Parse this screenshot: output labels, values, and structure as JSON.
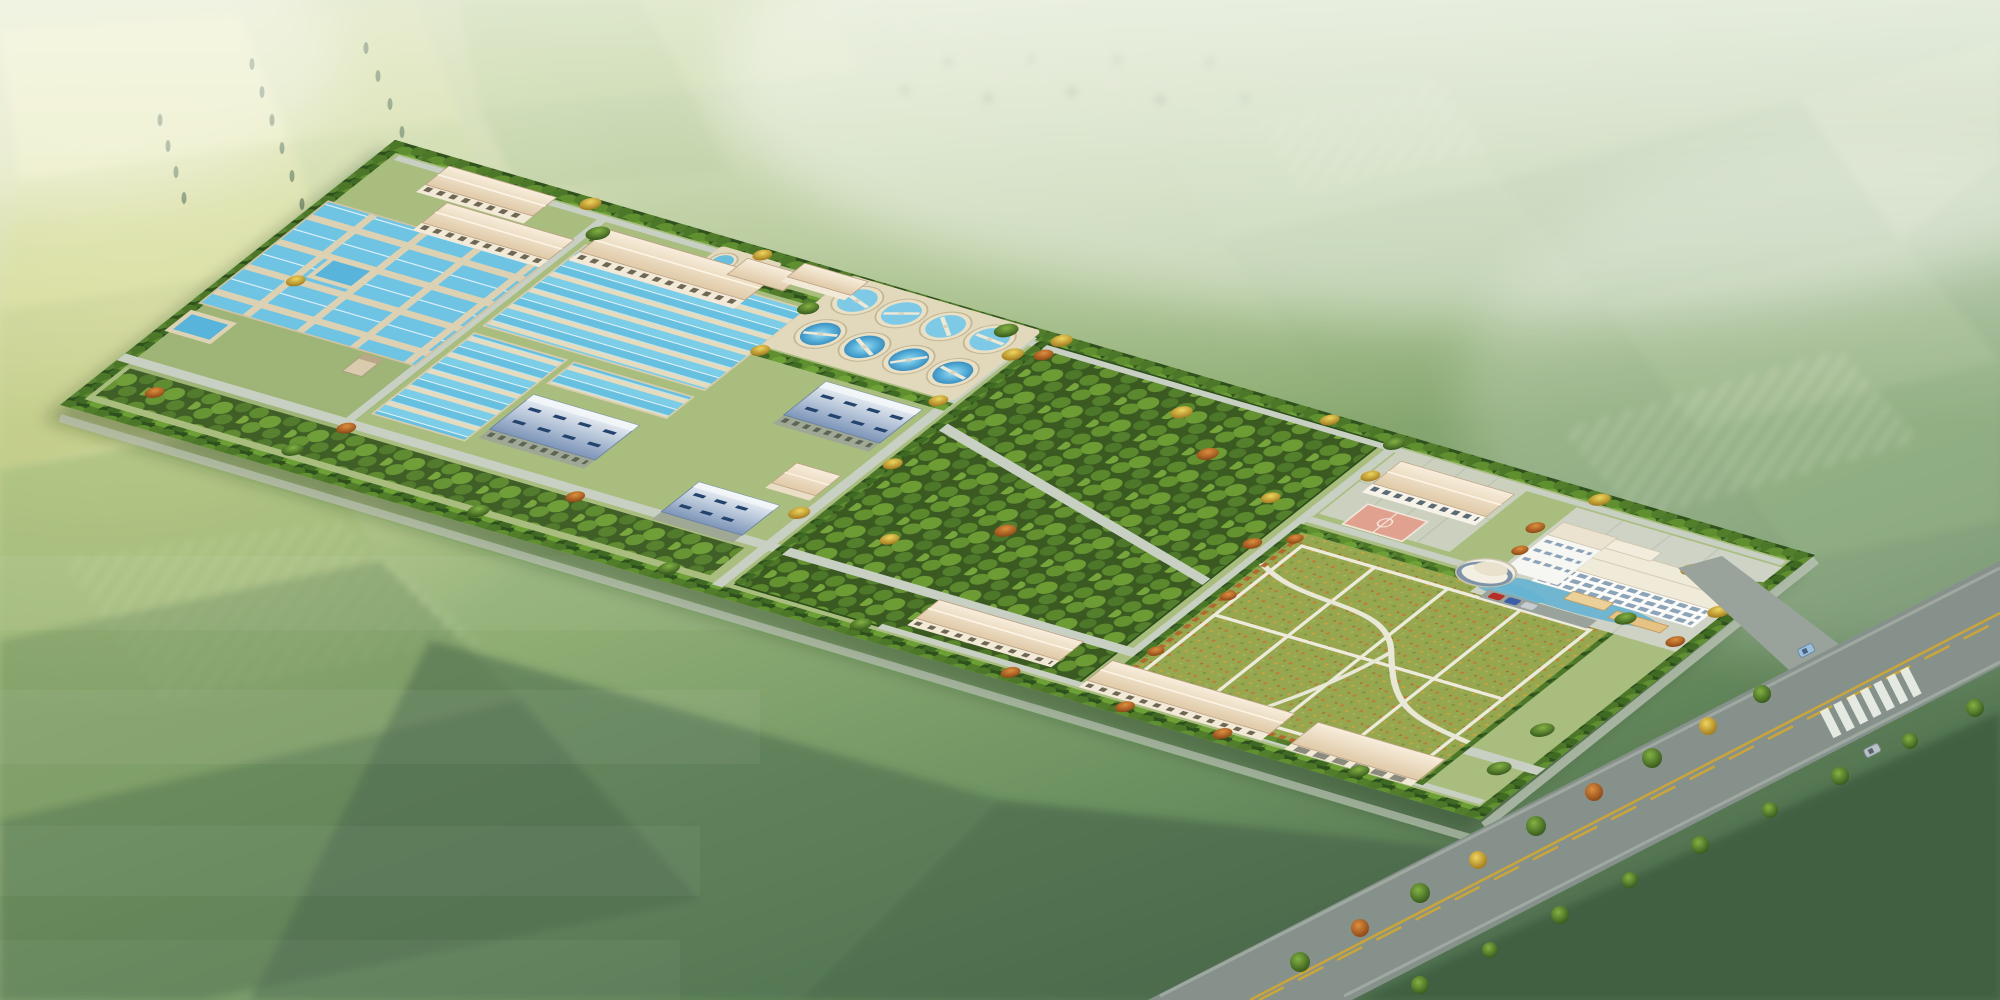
{
  "title": {
    "text": "成都市自来水七厂一期工程 --- 净水厂鸟瞰图"
  },
  "watermark": {
    "text": "中国市政工程西南设计研究总院"
  },
  "palette": {
    "farmland_light": "#d7dc9e",
    "farmland_mid": "#9cb87c",
    "farmland_dark": "#46654a",
    "basin_water_blue": "#6ec4e2",
    "basin_walkway_beige": "#e5dbbf",
    "roof_beige": "#eadcbf",
    "roof_blue": "#8fa7c8",
    "tree_green": "#4e7a2a",
    "tree_yellow": "#e0b63e",
    "tree_orange": "#c87434",
    "road_gray": "#87918b",
    "lane_marking_yellow": "#caa63a",
    "lawn_green": "#96a750",
    "sport_court_pink": "#e0a18f",
    "office_white": "#fbfbf9",
    "haze_white": "#ffffff"
  }
}
